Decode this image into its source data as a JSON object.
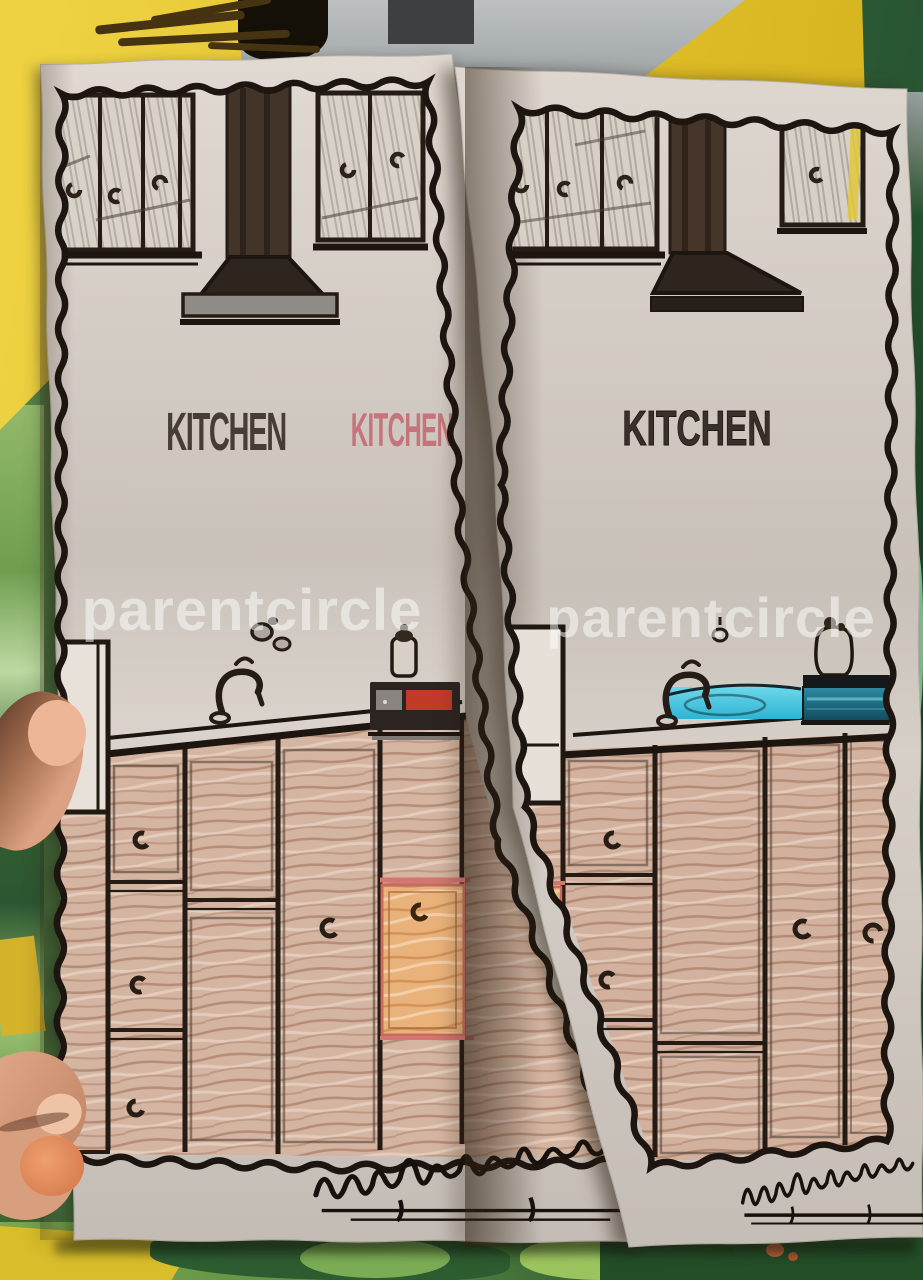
{
  "photo": {
    "pages": {
      "left": {
        "title": "KITCHEN",
        "title_partial": "KITCHEN",
        "watermark": "parentcircle"
      },
      "right": {
        "title": "KITCHEN",
        "watermark": "parentcircle"
      },
      "signature": {
        "present": true,
        "legible": false,
        "style": "handwritten cursive, underlined"
      }
    },
    "colors": {
      "table_green": "#3c6b3a",
      "mat_green_light": "#8fc05f",
      "mat_green_dark": "#2a5530",
      "folder_yellow": "#e5c531",
      "paper": "#ded7cf",
      "outline": "#201811",
      "wood_tan": "#d6b7a3",
      "wood_orange": "#e8b077",
      "sink_cyan": "#49cbe3",
      "appliance_teal": "#1e6f85",
      "appliance_red": "#c03a28",
      "watermark_white": "#ffffff",
      "skin": "#d9a584",
      "title_dark": "#3b332b",
      "title_red": "#c4606a"
    }
  }
}
